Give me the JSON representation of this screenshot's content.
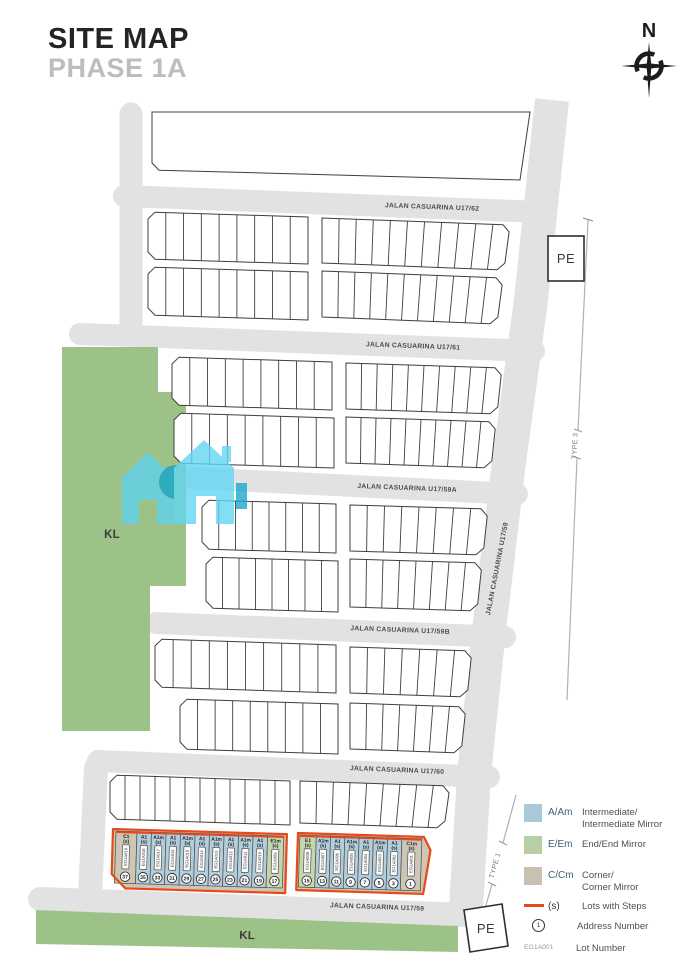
{
  "header": {
    "title": "SITE MAP",
    "subtitle": "PHASE 1A",
    "compass_label": "N"
  },
  "streets": {
    "u17_62": "JALAN CASUARINA U17/62",
    "u17_61": "JALAN CASUARINA U17/61",
    "u17_59a": "JALAN CASUARINA U17/59A",
    "u17_59b": "JALAN CASUARINA U17/59B",
    "u17_60": "JALAN CASUARINA U17/60",
    "u17_59": "JALAN CASUARINA U17/59",
    "u17_59_diagonal": "JALAN CASUARINA U17/59"
  },
  "labels": {
    "kl_left": "KL",
    "kl_bottom": "KL",
    "pe_top": "PE",
    "pe_bottom": "PE",
    "type_3": "TYPE 3",
    "type_1": "TYPE 1"
  },
  "legend": {
    "items": [
      {
        "code": "A/Am",
        "label": "Intermediate/\nIntermediate Mirror",
        "swatch": "intermediate"
      },
      {
        "code": "E/Em",
        "label": "End/End Mirror",
        "swatch": "end"
      },
      {
        "code": "C/Cm",
        "label": "Corner/\nCorner Mirror",
        "swatch": "corner"
      },
      {
        "code": "(s)",
        "label": "Lots with Steps",
        "swatch": "steps_line"
      },
      {
        "code": "1",
        "label": "Address Number",
        "swatch": "address_circle"
      },
      {
        "code": "EG1A001",
        "label": "Lot Number",
        "swatch": "lot_number"
      }
    ]
  },
  "featured_blocks": [
    {
      "name": "lots-17-37",
      "lots": [
        {
          "label": "C1",
          "steps": "(s)",
          "lot_number": "EG1A019",
          "address": "37",
          "type": "C"
        },
        {
          "label": "A1",
          "steps": "(s)",
          "lot_number": "EG1A018",
          "address": "35",
          "type": "A"
        },
        {
          "label": "A1m",
          "steps": "(s)",
          "lot_number": "EG1A017",
          "address": "33",
          "type": "A"
        },
        {
          "label": "A1",
          "steps": "(s)",
          "lot_number": "EG1A016",
          "address": "31",
          "type": "A"
        },
        {
          "label": "A1m",
          "steps": "(s)",
          "lot_number": "EG1A015",
          "address": "29",
          "type": "A"
        },
        {
          "label": "A1",
          "steps": "(s)",
          "lot_number": "EG1A014",
          "address": "27",
          "type": "A"
        },
        {
          "label": "A1m",
          "steps": "(s)",
          "lot_number": "EG1A013",
          "address": "25",
          "type": "A"
        },
        {
          "label": "A1",
          "steps": "(s)",
          "lot_number": "EG1A012",
          "address": "23",
          "type": "A"
        },
        {
          "label": "A1m",
          "steps": "(s)",
          "lot_number": "EG1A011",
          "address": "21",
          "type": "A"
        },
        {
          "label": "A1",
          "steps": "(s)",
          "lot_number": "EG1A010",
          "address": "19",
          "type": "A"
        },
        {
          "label": "E1m",
          "steps": "(s)",
          "lot_number": "EG1A009",
          "address": "17",
          "type": "E"
        }
      ]
    },
    {
      "name": "lots-1-15",
      "lots": [
        {
          "label": "E1",
          "steps": "(s)",
          "lot_number": "EG1A008",
          "address": "15",
          "type": "E"
        },
        {
          "label": "A1m",
          "steps": "(s)",
          "lot_number": "EG1A007",
          "address": "13",
          "type": "A"
        },
        {
          "label": "A1",
          "steps": "(s)",
          "lot_number": "EG1A006",
          "address": "11",
          "type": "A"
        },
        {
          "label": "A1m",
          "steps": "(s)",
          "lot_number": "EG1A005",
          "address": "9",
          "type": "A"
        },
        {
          "label": "A1",
          "steps": "(s)",
          "lot_number": "EG1A004",
          "address": "7",
          "type": "A"
        },
        {
          "label": "A1m",
          "steps": "(s)",
          "lot_number": "EG1A003",
          "address": "5",
          "type": "A"
        },
        {
          "label": "A1",
          "steps": "(s)",
          "lot_number": "EG1A002",
          "address": "3",
          "type": "A"
        },
        {
          "label": "C1m",
          "steps": "(s)",
          "lot_number": "EG1A001",
          "address": "1",
          "type": "C"
        }
      ]
    }
  ],
  "colors": {
    "intermediate": "#aac9d8",
    "end": "#b7cfa4",
    "corner": "#c8c1b0",
    "steps_line": "#e8491b",
    "road": "#e2e2e2",
    "green_area": "#9cc287",
    "lot_a_fill": "#b2cedd",
    "lot_e_fill": "#c3d6ac",
    "lot_c_fill": "#cdc6b5",
    "outline": "#3f3f3f"
  }
}
